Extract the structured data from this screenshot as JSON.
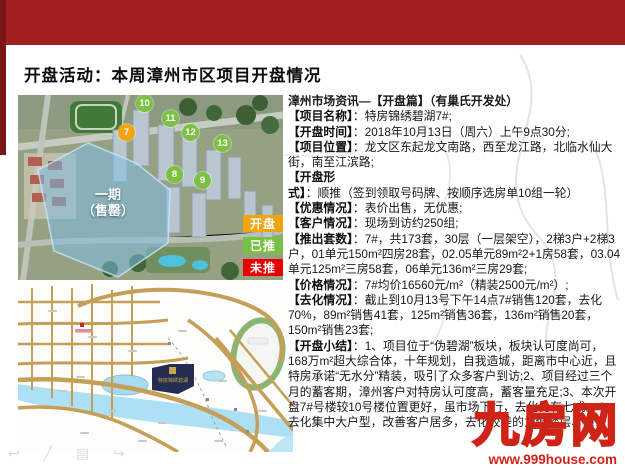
{
  "slide": {
    "title": "开盘活动：本周漳州市区项目开盘情况"
  },
  "aerial": {
    "phase_line1": "一期",
    "phase_line2": "（售罄）",
    "markers": [
      {
        "num": "7",
        "status": "opening"
      },
      {
        "num": "10",
        "status": "pushed"
      },
      {
        "num": "11",
        "status": "pushed"
      },
      {
        "num": "12",
        "status": "pushed"
      },
      {
        "num": "13",
        "status": "pushed"
      },
      {
        "num": "8",
        "status": "pushed"
      },
      {
        "num": "9",
        "status": "pushed"
      }
    ],
    "legend": [
      {
        "label": "开盘",
        "color": "#f2a40e"
      },
      {
        "label": "已推",
        "color": "#76c043"
      },
      {
        "label": "未推",
        "color": "#e60000"
      }
    ]
  },
  "map": {
    "project_label": "特房锦绣碧湖"
  },
  "info": {
    "header": "漳州市场资讯—【开盘篇】（有巢氏开发处）",
    "items": [
      {
        "label": "【项目名称】",
        "text": "：特房锦绣碧湖7#;"
      },
      {
        "label": "【开盘时间】",
        "text": "：2018年10月13日（周六）上午9点30分;"
      },
      {
        "label": "【项目位置】",
        "text": "：龙文区东起龙文南路，西至龙江路，北临水仙大街，南至江滨路;"
      },
      {
        "label": "【开盘形式】",
        "text": "：顺推（签到领取号码牌、按顺序选房单10组一轮）"
      },
      {
        "label": "【优惠情况】",
        "text": "：表价出售，无优惠;"
      },
      {
        "label": "【客户情况】",
        "text": "：现场到访约250组;"
      },
      {
        "label": "【推出套数】",
        "text": "：7#，共173套，30层（一层架空），2梯3户+2梯3户，01单元150m²四房28套，02.05单元89m²2+1房58套，03.04单元125m²三房58套，06单元136m²三房29套;"
      },
      {
        "label": "【价格情况】",
        "text": "：7#均价16560元/m²（精装2500元/m²）;"
      },
      {
        "label": "【去化情况】",
        "text": "：截止到10月13号下午14点7#销售120套，去化70%，89m²销售41套，125m²销售36套，136m²销售20套，150m²销售23套;"
      },
      {
        "label": "【开盘小结】",
        "text": "：1、项目位于“伪碧湖”板块，板块认可度尚可，168万m²超大综合体，十年规划，自我造城，距离市中心近，且特房承诺“无水分”精装，吸引了众多客户到访;2、项目经过三个月的蓄客期，漳州客户对特房认可度高，蓄客量充足;3、本次开盘7#号楼较10号楼位置更好，虽市场下行，去化仍有七成。4、去化集中大户型，改善客户居多，去化较差的为低楼层、西…"
      }
    ]
  },
  "watermark": {
    "brand": "九房网",
    "url": "www.999house.com"
  },
  "footer_icons": "↩ ╱ ▤ ↪",
  "colors": {
    "top_band": "#a21d1d",
    "left_stripe": "#7b1517",
    "marker_green": "#7cc142",
    "marker_orange": "#f2a40e",
    "legend_red": "#e60000",
    "watermark_red": "#cf2318"
  }
}
